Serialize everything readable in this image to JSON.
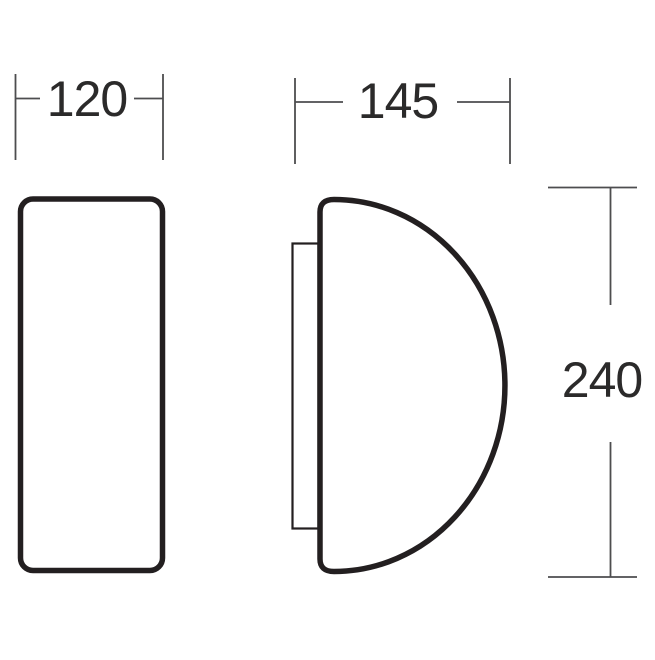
{
  "diagram": {
    "type": "technical-drawing",
    "dimensions": {
      "width": "120",
      "depth": "145",
      "height": "240"
    },
    "colors": {
      "outline": "#231f20",
      "dimension": "#4d4d4f",
      "text": "#2b2a2a",
      "background": "#ffffff"
    }
  }
}
